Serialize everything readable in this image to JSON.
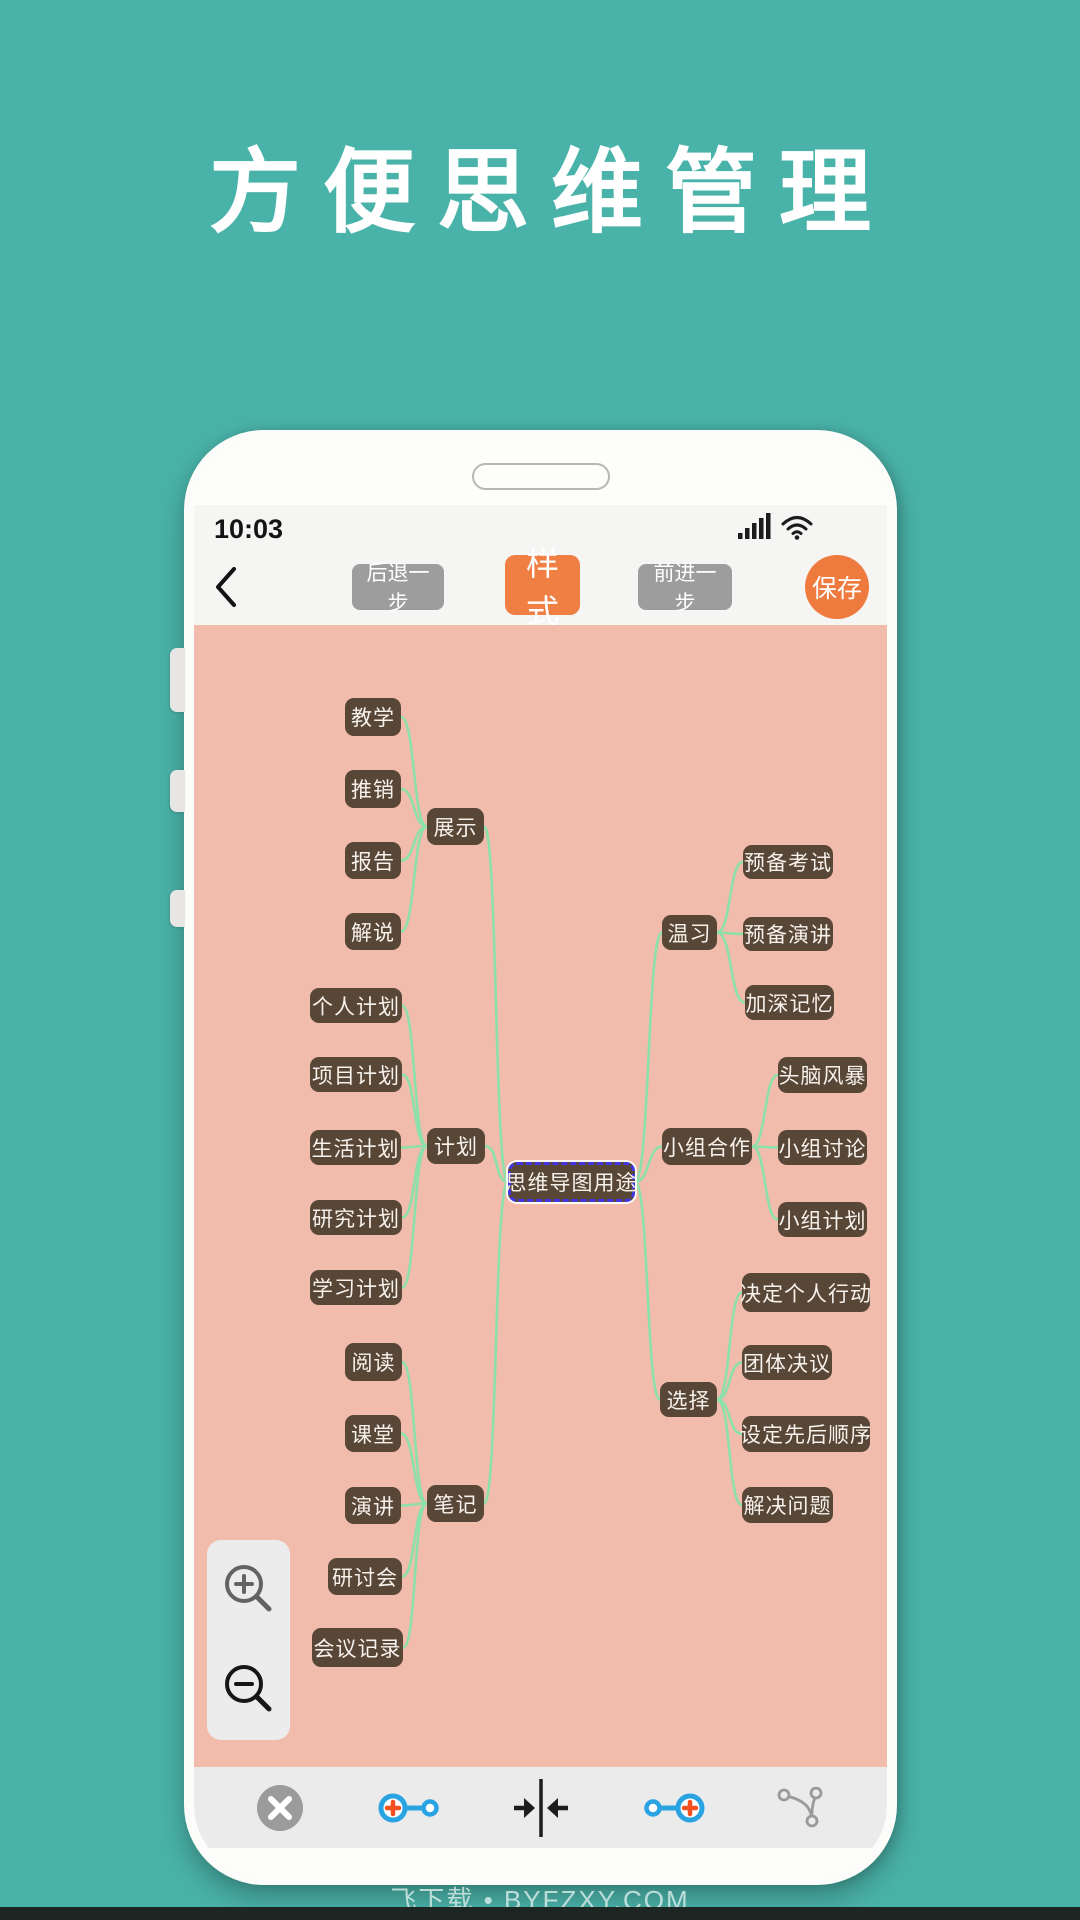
{
  "page": {
    "title": "方便思维管理",
    "watermark": "飞下载 • BYFZXY.COM",
    "colors": {
      "background_teal": "#4ab3a9",
      "canvas_pink": "#f1bcab",
      "node_brown": "#584637",
      "node_text": "#f7f2ec",
      "edge_green": "#8ce0aa",
      "accent_orange": "#f07f44",
      "gray_button": "#9d9d9d",
      "selected_border_blue": "#4336e4"
    }
  },
  "phone": {
    "status_bar": {
      "time": "10:03",
      "icons": [
        "signal-bars-icon",
        "wifi-icon"
      ]
    },
    "toolbar": {
      "back_icon": "chevron-left-icon",
      "undo_label": "后退一步",
      "style_label": "样式",
      "redo_label": "前进一步",
      "save_label": "保存"
    },
    "side_buttons": [
      "power-button",
      "volume-up-button",
      "volume-down-button"
    ],
    "mindmap": {
      "root_label": "思维导图用途",
      "nodes": [
        {
          "id": "jiaoxue",
          "label": "教学",
          "x": 151,
          "y": 73,
          "w": 56,
          "h": 38
        },
        {
          "id": "tuixiao",
          "label": "推销",
          "x": 151,
          "y": 145,
          "w": 56,
          "h": 38
        },
        {
          "id": "zhanshi",
          "label": "展示",
          "x": 233,
          "y": 183,
          "w": 57,
          "h": 37
        },
        {
          "id": "baogao",
          "label": "报告",
          "x": 151,
          "y": 217,
          "w": 56,
          "h": 37
        },
        {
          "id": "jieshuo",
          "label": "解说",
          "x": 151,
          "y": 288,
          "w": 56,
          "h": 37
        },
        {
          "id": "gerenjihua",
          "label": "个人计划",
          "x": 116,
          "y": 363,
          "w": 92,
          "h": 35
        },
        {
          "id": "xiangmujihua",
          "label": "项目计划",
          "x": 116,
          "y": 432,
          "w": 92,
          "h": 35
        },
        {
          "id": "shenghuojihua",
          "label": "生活计划",
          "x": 116,
          "y": 505,
          "w": 91,
          "h": 35
        },
        {
          "id": "jihua",
          "label": "计划",
          "x": 233,
          "y": 503,
          "w": 58,
          "h": 36
        },
        {
          "id": "yanjiujihua",
          "label": "研究计划",
          "x": 116,
          "y": 575,
          "w": 92,
          "h": 35
        },
        {
          "id": "xuexijihua",
          "label": "学习计划",
          "x": 116,
          "y": 645,
          "w": 92,
          "h": 35
        },
        {
          "id": "yuedu",
          "label": "阅读",
          "x": 151,
          "y": 718,
          "w": 57,
          "h": 38
        },
        {
          "id": "ketang",
          "label": "课堂",
          "x": 151,
          "y": 790,
          "w": 56,
          "h": 37
        },
        {
          "id": "yanjiang",
          "label": "演讲",
          "x": 151,
          "y": 862,
          "w": 56,
          "h": 37
        },
        {
          "id": "biji",
          "label": "笔记",
          "x": 233,
          "y": 860,
          "w": 57,
          "h": 37
        },
        {
          "id": "yantaohui",
          "label": "研讨会",
          "x": 134,
          "y": 933,
          "w": 74,
          "h": 37
        },
        {
          "id": "huiyijilu",
          "label": "会议记录",
          "x": 118,
          "y": 1003,
          "w": 91,
          "h": 39
        },
        {
          "id": "root",
          "label": "思维导图用途",
          "x": 314,
          "y": 537,
          "w": 127,
          "h": 40,
          "selected": true
        },
        {
          "id": "yubeikaoshi",
          "label": "预备考试",
          "x": 549,
          "y": 220,
          "w": 90,
          "h": 34
        },
        {
          "id": "wenxi",
          "label": "温习",
          "x": 468,
          "y": 290,
          "w": 55,
          "h": 35
        },
        {
          "id": "yubeiyanjiang",
          "label": "预备演讲",
          "x": 549,
          "y": 292,
          "w": 90,
          "h": 34
        },
        {
          "id": "jiashenjiyi",
          "label": "加深记忆",
          "x": 551,
          "y": 360,
          "w": 89,
          "h": 35
        },
        {
          "id": "tounaofengbao",
          "label": "头脑风暴",
          "x": 584,
          "y": 432,
          "w": 89,
          "h": 36
        },
        {
          "id": "xiaozuhezuo",
          "label": "小组合作",
          "x": 468,
          "y": 503,
          "w": 90,
          "h": 37
        },
        {
          "id": "xiaozutaolun",
          "label": "小组讨论",
          "x": 584,
          "y": 505,
          "w": 89,
          "h": 35
        },
        {
          "id": "xiaozujihua",
          "label": "小组计划",
          "x": 584,
          "y": 577,
          "w": 89,
          "h": 35
        },
        {
          "id": "juedinggeren",
          "label": "决定个人行动",
          "x": 548,
          "y": 648,
          "w": 128,
          "h": 39
        },
        {
          "id": "tuantijueyi",
          "label": "团体决议",
          "x": 548,
          "y": 720,
          "w": 90,
          "h": 35
        },
        {
          "id": "xuanze",
          "label": "选择",
          "x": 466,
          "y": 757,
          "w": 57,
          "h": 35
        },
        {
          "id": "shedingshunxu",
          "label": "设定先后顺序",
          "x": 548,
          "y": 791,
          "w": 128,
          "h": 36
        },
        {
          "id": "jiejuewenti",
          "label": "解决问题",
          "x": 548,
          "y": 862,
          "w": 91,
          "h": 36
        }
      ],
      "edges": [
        [
          "jiaoxue",
          "zhanshi"
        ],
        [
          "tuixiao",
          "zhanshi"
        ],
        [
          "baogao",
          "zhanshi"
        ],
        [
          "jieshuo",
          "zhanshi"
        ],
        [
          "zhanshi",
          "root"
        ],
        [
          "gerenjihua",
          "jihua"
        ],
        [
          "xiangmujihua",
          "jihua"
        ],
        [
          "shenghuojihua",
          "jihua"
        ],
        [
          "yanjiujihua",
          "jihua"
        ],
        [
          "xuexijihua",
          "jihua"
        ],
        [
          "jihua",
          "root"
        ],
        [
          "yuedu",
          "biji"
        ],
        [
          "ketang",
          "biji"
        ],
        [
          "yanjiang",
          "biji"
        ],
        [
          "yantaohui",
          "biji"
        ],
        [
          "huiyijilu",
          "biji"
        ],
        [
          "biji",
          "root"
        ],
        [
          "root",
          "wenxi"
        ],
        [
          "wenxi",
          "yubeikaoshi"
        ],
        [
          "wenxi",
          "yubeiyanjiang"
        ],
        [
          "wenxi",
          "jiashenjiyi"
        ],
        [
          "root",
          "xiaozuhezuo"
        ],
        [
          "xiaozuhezuo",
          "tounaofengbao"
        ],
        [
          "xiaozuhezuo",
          "xiaozutaolun"
        ],
        [
          "xiaozuhezuo",
          "xiaozujihua"
        ],
        [
          "root",
          "xuanze"
        ],
        [
          "xuanze",
          "juedinggeren"
        ],
        [
          "xuanze",
          "tuantijueyi"
        ],
        [
          "xuanze",
          "shedingshunxu"
        ],
        [
          "xuanze",
          "jiejuewenti"
        ]
      ]
    },
    "zoom_controls": {
      "buttons": [
        "zoom-in-icon",
        "zoom-out-icon"
      ]
    },
    "bottom_toolbar": {
      "icons": [
        "close-icon",
        "add-node-before-icon",
        "collapse-horizontal-icon",
        "add-node-after-icon",
        "branch-layout-icon"
      ]
    }
  }
}
